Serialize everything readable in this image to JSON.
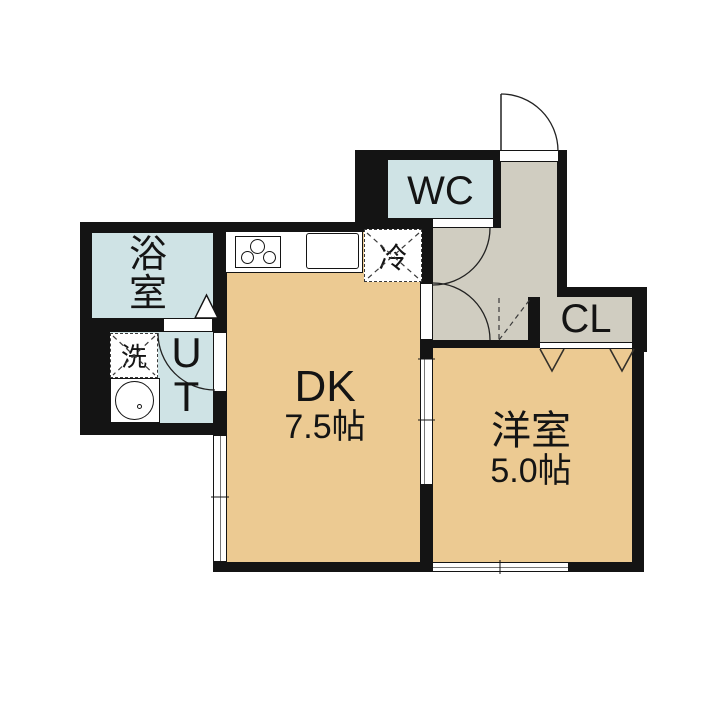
{
  "floor_plan": {
    "type": "apartment-floorplan",
    "rooms": {
      "bath": {
        "label": "浴室"
      },
      "utility": {
        "label": "UT"
      },
      "wc": {
        "label": "WC"
      },
      "dining_kitchen": {
        "label": "DK",
        "size": "7.5帖"
      },
      "western_room": {
        "label": "洋室",
        "size": "5.0帖"
      },
      "closet": {
        "label": "CL"
      }
    },
    "fixtures": {
      "laundry": {
        "label": "洗"
      },
      "refrigerator": {
        "label": "冷"
      }
    },
    "colors": {
      "wall": "#141414",
      "room_floor_tan": "#ecca92",
      "wet_area_blue": "#cfe3e5",
      "hallway_gray": "#d0cdc1",
      "background": "#ffffff"
    }
  }
}
